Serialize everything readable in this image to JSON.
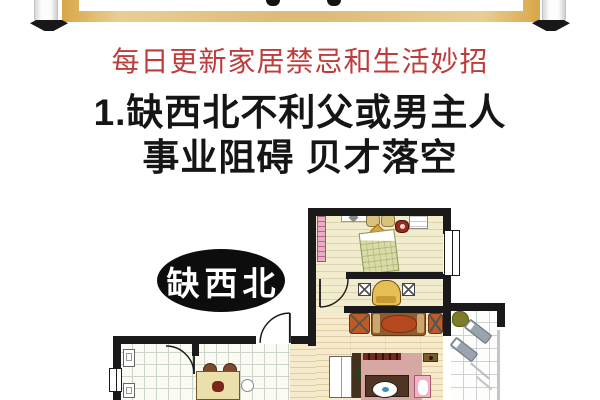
{
  "subtitle": {
    "text": "每日更新家居禁忌和生活妙招"
  },
  "heading": {
    "line1": "1.缺西北不利父或男主人",
    "line2": "事业阻碍 贝才落空"
  },
  "floorplan": {
    "label": "缺西北",
    "rooms": [
      "bedroom",
      "study-nook",
      "living-room",
      "kitchen-dining",
      "balcony"
    ]
  },
  "colors": {
    "subtitle_red": "#BE3C3C",
    "heading_black": "#151515",
    "banner_gold": "#DDBC79",
    "label_bg": "#0D0D0D",
    "label_text": "#FFFFFF",
    "wall": "#1A1A1A",
    "wood_floor": "#F5EACB",
    "bedroom_floor": "#F2ECCF",
    "tile_line": "#CBD4C8",
    "bed_green": "#D8DCA4",
    "sofa_rust": "#BC5A28",
    "armchair_gold": "#E5BE55",
    "wardrobe_pink": "#E8AFC4",
    "vanity_pink": "#D7A7A3"
  }
}
